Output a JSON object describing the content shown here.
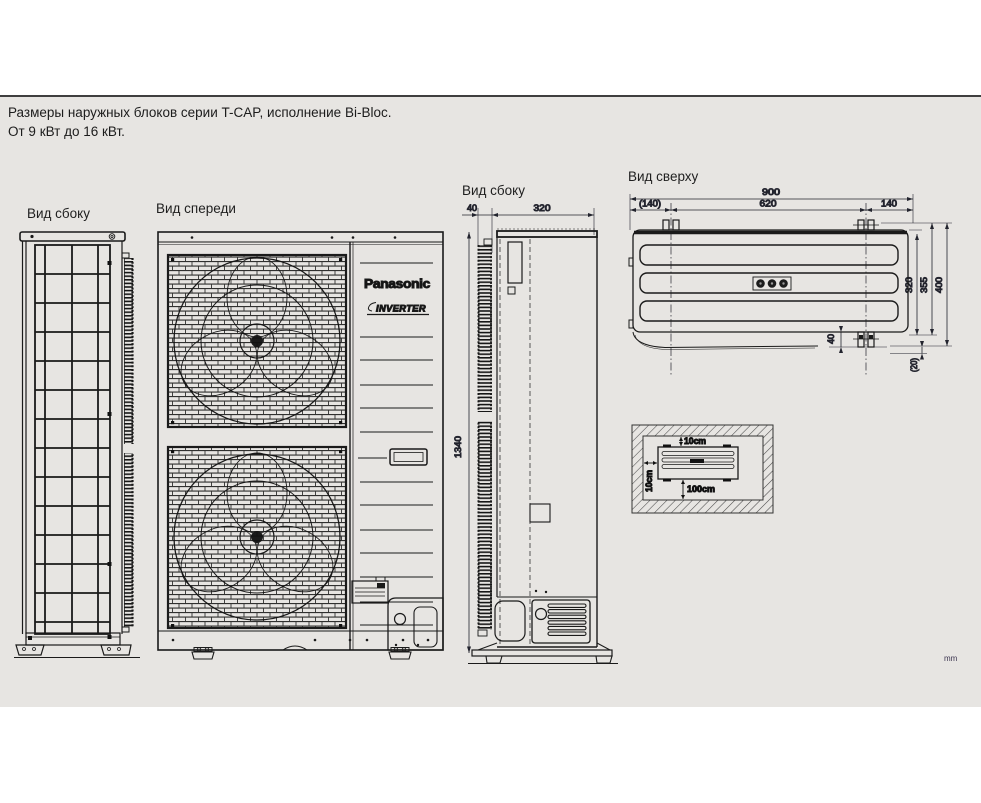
{
  "page": {
    "heading_line1": "Размеры наружных блоков серии T-CAP, исполнение Bi-Bloc.",
    "heading_line2": "От 9 кВт до 16 кВт.",
    "units_label": "mm"
  },
  "branding": {
    "logo": "Panasonic",
    "inverter_badge": "INVERTER"
  },
  "views": {
    "side_left": {
      "label": "Вид сбоку"
    },
    "front": {
      "label": "Вид спереди"
    },
    "side_right": {
      "label": "Вид сбоку",
      "dims": {
        "fin_depth": "40",
        "body_depth": "320",
        "height": "1340"
      }
    },
    "top": {
      "label": "Вид сверху",
      "dims": {
        "overall_width": "900",
        "left_bracket_offset": "(140)",
        "bracket_spacing": "620",
        "right_bracket_offset": "140",
        "body_depth": "320",
        "mid_depth": "355",
        "overall_depth": "400",
        "bracket_height": "40",
        "rear_gap": "(20)"
      }
    },
    "clearance": {
      "top_gap": "10cm",
      "side_gap": "10cm",
      "front_gap": "100cm"
    }
  },
  "colors": {
    "band_background": "#e7e5e2",
    "line": "#1a1a1a",
    "top_rule": "#3f3f3f"
  }
}
